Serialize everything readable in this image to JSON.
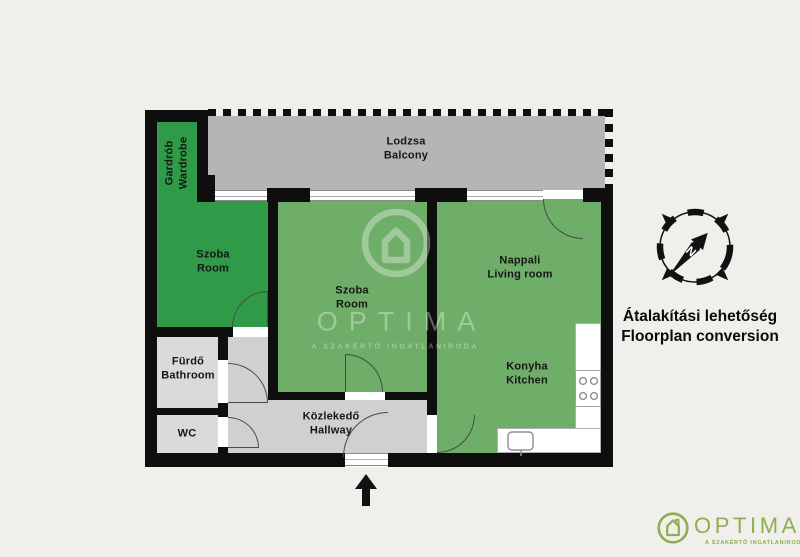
{
  "page": {
    "background": "#f0efeb"
  },
  "plan": {
    "rooms": {
      "balcony": {
        "hu": "Lodzsa",
        "en": "Balcony"
      },
      "wardrobe": {
        "hu": "Gardrób",
        "en": "Wardrobe"
      },
      "room_left": {
        "hu": "Szoba",
        "en": "Room"
      },
      "room_middle": {
        "hu": "Szoba",
        "en": "Room"
      },
      "living_room": {
        "hu": "Nappali",
        "en": "Living room"
      },
      "kitchen": {
        "hu": "Konyha",
        "en": "Kitchen"
      },
      "bathroom": {
        "hu": "Fürdő",
        "en": "Bathroom"
      },
      "wc": {
        "hu": "WC",
        "en": ""
      },
      "hallway": {
        "hu": "Közlekedő",
        "en": "Hallway"
      }
    }
  },
  "annotation": {
    "line1": "Átalakítási lehetőség",
    "line2": "Floorplan conversion"
  },
  "compass": {
    "north": "N"
  },
  "watermark": {
    "brand": "OPTIMA",
    "tagline": "A SZAKÉRTŐ INGATLANIRODA"
  },
  "footer": {
    "brand": "OPTIMA",
    "tagline": "A SZAKÉRTŐ INGATLANIRODA"
  },
  "colors": {
    "dark_green": "#2f9b49",
    "light_green": "#6fae69",
    "balcony_gray": "#b5b5b5",
    "hall_gray": "#d0d0d0",
    "bath_gray": "#dadada",
    "wall_black": "#0e0e0e",
    "brand_green": "#8cb04f"
  }
}
